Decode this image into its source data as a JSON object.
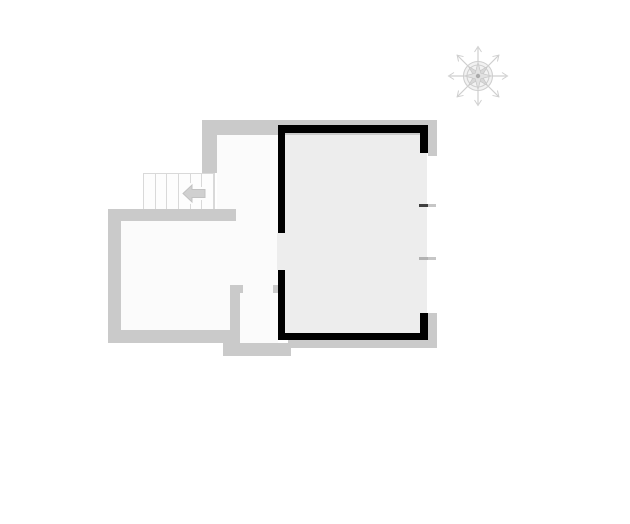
{
  "meta": {
    "document_type": "architectural-floor-plan",
    "description": "Floor plan with one room highlighted by heavy black walls, light gray exterior walls, a staircase with a left-pointing direction arrow, and a compass rose at top right",
    "visible_text": ""
  },
  "palette": {
    "background": "#ffffff",
    "exterior_wall": "#cacaca",
    "highlight_wall": "#000000",
    "highlight_room_fill": "#ededed",
    "room_fill": "#fbfbfb",
    "stair_fill": "#fdfdfd",
    "stair_line": "#d9d9d9",
    "arrow_fill": "#d0d0d0",
    "arrow_edge": "#c2c2c2",
    "compass_stroke": "#cfcfcf",
    "tick_dark": "#3f3f3f",
    "tick_mid": "#b2b2b2",
    "tick_light": "#c6c6c6"
  },
  "plan": {
    "room_fills": [
      {
        "name": "hallway-floor",
        "x": 217,
        "y": 135,
        "w": 61,
        "h": 208,
        "color": "room_fill"
      },
      {
        "name": "left-room-floor",
        "x": 121,
        "y": 220,
        "w": 157,
        "h": 123,
        "color": "room_fill"
      },
      {
        "name": "highlighted-room-floor",
        "x": 285,
        "y": 133,
        "w": 142,
        "h": 200,
        "color": "highlight_room_fill"
      },
      {
        "name": "west-doorway-floor",
        "x": 277,
        "y": 233,
        "w": 8,
        "h": 37,
        "color": "highlight_room_fill"
      }
    ],
    "gray_walls": [
      {
        "name": "north-exterior-wall",
        "x": 202,
        "y": 120,
        "w": 235,
        "h": 15
      },
      {
        "name": "northeast-exterior-wall",
        "x": 428,
        "y": 135,
        "w": 9,
        "h": 21
      },
      {
        "name": "northwest-hall-wall",
        "x": 202,
        "y": 135,
        "w": 15,
        "h": 38
      },
      {
        "name": "stair-landing-wall",
        "x": 108,
        "y": 209,
        "w": 128,
        "h": 12
      },
      {
        "name": "left-room-west-wall",
        "x": 108,
        "y": 209,
        "w": 13,
        "h": 134
      },
      {
        "name": "left-room-south-wall",
        "x": 108,
        "y": 330,
        "w": 123,
        "h": 13
      },
      {
        "name": "vestibule-west-wall",
        "x": 230,
        "y": 285,
        "w": 10,
        "h": 62
      },
      {
        "name": "vestibule-door-jamb-left",
        "x": 230,
        "y": 285,
        "w": 13,
        "h": 8
      },
      {
        "name": "vestibule-door-jamb-right",
        "x": 273,
        "y": 285,
        "w": 5,
        "h": 8
      },
      {
        "name": "vestibule-south-wall",
        "x": 223,
        "y": 343,
        "w": 68,
        "h": 13
      },
      {
        "name": "south-exterior-wall",
        "x": 288,
        "y": 340,
        "w": 149,
        "h": 8
      },
      {
        "name": "southeast-exterior-wall",
        "x": 427,
        "y": 313,
        "w": 10,
        "h": 35
      }
    ],
    "black_walls": [
      {
        "name": "highlight-north-wall",
        "x": 278,
        "y": 125,
        "w": 150,
        "h": 8
      },
      {
        "name": "highlight-west-wall-upper",
        "x": 278,
        "y": 133,
        "w": 7,
        "h": 100
      },
      {
        "name": "highlight-west-wall-lower",
        "x": 278,
        "y": 270,
        "w": 7,
        "h": 70
      },
      {
        "name": "highlight-south-wall",
        "x": 285,
        "y": 333,
        "w": 143,
        "h": 7
      },
      {
        "name": "highlight-ne-corner-wall",
        "x": 420,
        "y": 133,
        "w": 8,
        "h": 20
      },
      {
        "name": "highlight-se-corner-wall",
        "x": 420,
        "y": 313,
        "w": 8,
        "h": 20
      }
    ],
    "window_ticks": [
      {
        "name": "east-opening-tick-upper-inner",
        "x": 419,
        "y": 204,
        "w": 9,
        "h": 3,
        "color": "tick_dark"
      },
      {
        "name": "east-opening-tick-upper-outer",
        "x": 428,
        "y": 204,
        "w": 8,
        "h": 3,
        "color": "tick_light"
      },
      {
        "name": "east-opening-tick-lower-inner",
        "x": 419,
        "y": 257,
        "w": 9,
        "h": 3,
        "color": "tick_mid"
      },
      {
        "name": "east-opening-tick-lower-outer",
        "x": 428,
        "y": 257,
        "w": 8,
        "h": 3,
        "color": "tick_light"
      }
    ],
    "staircase": {
      "x": 143,
      "y": 173,
      "w": 72,
      "h": 38,
      "treads": 6,
      "arrow_direction": "left"
    },
    "compass": {
      "x": 446,
      "y": 44,
      "size": 64
    }
  }
}
